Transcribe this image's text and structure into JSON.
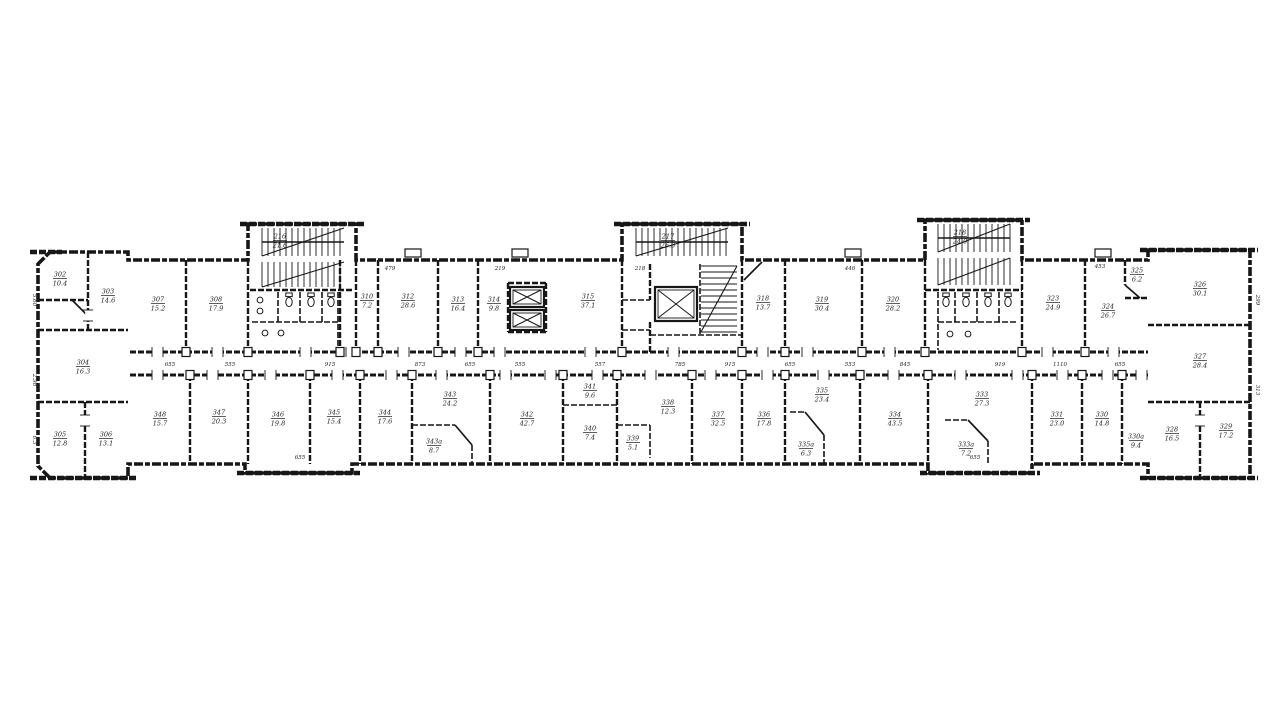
{
  "plan": {
    "ink": "#171717",
    "paper": "#ffffff",
    "outline": [
      38,
      264,
      50,
      252,
      128,
      252,
      128,
      260,
      248,
      260,
      248,
      224,
      356,
      224,
      356,
      260,
      622,
      260,
      622,
      224,
      742,
      224,
      742,
      260,
      925,
      260,
      925,
      220,
      1022,
      220,
      1022,
      260,
      1148,
      260,
      1148,
      250,
      1250,
      250,
      1250,
      478,
      1148,
      478,
      1148,
      464,
      1032,
      464,
      1032,
      473,
      928,
      473,
      928,
      464,
      352,
      464,
      352,
      473,
      245,
      473,
      245,
      464,
      128,
      464,
      128,
      478,
      50,
      478,
      38,
      466
    ],
    "caps": [
      [
        240,
        224,
        364,
        224
      ],
      [
        614,
        224,
        750,
        224
      ],
      [
        917,
        220,
        1030,
        220
      ],
      [
        30,
        252,
        62,
        252
      ],
      [
        1140,
        250,
        1258,
        250
      ],
      [
        237,
        473,
        360,
        473
      ],
      [
        920,
        473,
        1040,
        473
      ],
      [
        30,
        478,
        136,
        478
      ],
      [
        1140,
        478,
        1258,
        478
      ]
    ],
    "walls": [
      [
        130,
        352,
        1148,
        352,
        3
      ],
      [
        130,
        375,
        1148,
        375,
        3
      ],
      [
        38,
        330,
        128,
        330,
        2.4
      ],
      [
        38,
        402,
        128,
        402,
        2.4
      ],
      [
        38,
        300,
        88,
        300,
        2.4
      ],
      [
        88,
        252,
        88,
        330,
        2.4
      ],
      [
        85,
        402,
        85,
        478,
        2.4
      ],
      [
        1148,
        325,
        1250,
        325,
        2.4
      ],
      [
        1148,
        402,
        1250,
        402,
        2.4
      ],
      [
        1200,
        402,
        1200,
        478,
        2.4
      ],
      [
        1125,
        260,
        1125,
        285,
        2.4
      ],
      [
        1125,
        298,
        1148,
        298,
        2.4
      ],
      [
        186,
        260,
        186,
        352,
        2.4
      ],
      [
        248,
        260,
        248,
        352,
        2.4
      ],
      [
        340,
        260,
        340,
        352,
        2.4
      ],
      [
        356,
        260,
        356,
        352,
        2.4
      ],
      [
        378,
        260,
        378,
        352,
        2.4
      ],
      [
        438,
        260,
        438,
        352,
        2.4
      ],
      [
        478,
        260,
        478,
        352,
        2.4
      ],
      [
        508,
        283,
        508,
        332,
        2.4
      ],
      [
        546,
        283,
        546,
        332,
        2.4
      ],
      [
        508,
        283,
        546,
        283,
        2.4
      ],
      [
        508,
        332,
        546,
        332,
        2.4
      ],
      [
        622,
        260,
        622,
        352,
        2.4
      ],
      [
        650,
        264,
        650,
        300,
        2.4
      ],
      [
        650,
        322,
        650,
        352,
        2.4
      ],
      [
        742,
        260,
        742,
        352,
        2.4
      ],
      [
        785,
        260,
        785,
        352,
        2.4
      ],
      [
        862,
        260,
        862,
        352,
        2.4
      ],
      [
        925,
        260,
        925,
        352,
        2.4
      ],
      [
        1022,
        260,
        1022,
        352,
        2.4
      ],
      [
        1085,
        260,
        1085,
        352,
        2.4
      ],
      [
        250,
        290,
        354,
        290,
        2.4
      ],
      [
        252,
        322,
        338,
        322,
        1.6
      ],
      [
        278,
        292,
        278,
        322,
        1.6
      ],
      [
        300,
        292,
        300,
        322,
        1.6
      ],
      [
        322,
        292,
        322,
        322,
        1.6
      ],
      [
        338,
        292,
        338,
        352,
        1.6
      ],
      [
        622,
        300,
        650,
        300,
        1.6
      ],
      [
        622,
        330,
        650,
        330,
        1.6
      ],
      [
        700,
        264,
        700,
        335,
        1.6
      ],
      [
        650,
        335,
        742,
        335,
        1.6
      ],
      [
        925,
        290,
        1022,
        290,
        2.4
      ],
      [
        938,
        292,
        938,
        350,
        1.6
      ],
      [
        955,
        292,
        955,
        322,
        1.6
      ],
      [
        977,
        292,
        977,
        322,
        1.6
      ],
      [
        999,
        292,
        999,
        322,
        1.6
      ],
      [
        938,
        322,
        1018,
        322,
        1.6
      ],
      [
        190,
        375,
        190,
        464,
        2.4
      ],
      [
        248,
        375,
        248,
        464,
        2.4
      ],
      [
        310,
        375,
        310,
        464,
        2.4
      ],
      [
        360,
        375,
        360,
        464,
        2.4
      ],
      [
        412,
        375,
        412,
        464,
        2.4
      ],
      [
        490,
        375,
        490,
        464,
        2.4
      ],
      [
        563,
        375,
        563,
        464,
        2.4
      ],
      [
        617,
        375,
        617,
        464,
        2.4
      ],
      [
        692,
        375,
        692,
        464,
        2.4
      ],
      [
        742,
        375,
        742,
        464,
        2.4
      ],
      [
        785,
        375,
        785,
        464,
        2.4
      ],
      [
        860,
        375,
        860,
        464,
        2.4
      ],
      [
        928,
        375,
        928,
        464,
        2.4
      ],
      [
        1032,
        375,
        1032,
        464,
        2.4
      ],
      [
        1082,
        375,
        1082,
        464,
        2.4
      ],
      [
        1122,
        375,
        1122,
        464,
        2.4
      ],
      [
        412,
        425,
        455,
        425,
        1.6
      ],
      [
        472,
        445,
        472,
        464,
        1.6
      ],
      [
        563,
        405,
        617,
        405,
        1.6
      ],
      [
        617,
        425,
        650,
        425,
        1.6
      ],
      [
        650,
        425,
        650,
        458,
        1.6
      ],
      [
        790,
        412,
        805,
        412,
        1.6
      ],
      [
        824,
        435,
        824,
        464,
        1.6
      ],
      [
        945,
        420,
        968,
        420,
        1.6
      ],
      [
        988,
        441,
        988,
        464,
        1.6
      ]
    ],
    "diagonals": [
      [
        72,
        300,
        88,
        316
      ],
      [
        1125,
        285,
        1140,
        298
      ],
      [
        744,
        280,
        762,
        262
      ],
      [
        455,
        425,
        472,
        445
      ],
      [
        805,
        412,
        824,
        435
      ],
      [
        968,
        420,
        988,
        441
      ]
    ],
    "doors_top": [
      152,
      212,
      300,
      346,
      398,
      455,
      494,
      585,
      668,
      757,
      802,
      884,
      1042,
      1108
    ],
    "doors_bottom": [
      152,
      207,
      265,
      332,
      386,
      436,
      500,
      545,
      592,
      645,
      705,
      762,
      818,
      888,
      955,
      1012,
      1057,
      1102,
      1136
    ],
    "doors_vertical": [
      [
        88,
        310
      ],
      [
        85,
        415
      ],
      [
        1200,
        415
      ]
    ],
    "studs_top": [
      186,
      248,
      340,
      356,
      378,
      438,
      478,
      622,
      742,
      785,
      862,
      925,
      1022,
      1085
    ],
    "studs_bottom": [
      190,
      248,
      310,
      360,
      412,
      490,
      563,
      617,
      692,
      742,
      785,
      860,
      928,
      1032,
      1082,
      1122
    ],
    "tabs": [
      [
        405,
        249,
        16,
        8
      ],
      [
        512,
        249,
        16,
        8
      ],
      [
        845,
        249,
        16,
        8
      ],
      [
        1095,
        249,
        16,
        8
      ]
    ],
    "stairs": [
      {
        "type": "v",
        "x1": 262,
        "y1": 228,
        "x2": 344,
        "y2": 256,
        "step": 6,
        "mid": 1,
        "diag": 1
      },
      {
        "type": "v",
        "x1": 262,
        "y1": 262,
        "x2": 344,
        "y2": 287,
        "step": 6,
        "mid": 0,
        "diag": 1
      },
      {
        "type": "v",
        "x1": 636,
        "y1": 228,
        "x2": 728,
        "y2": 256,
        "step": 6,
        "mid": 1,
        "diag": 1
      },
      {
        "type": "h",
        "x1": 701,
        "y1": 266,
        "x2": 737,
        "y2": 332,
        "step": 6,
        "mid": 0,
        "diag": 1
      },
      {
        "type": "v",
        "x1": 938,
        "y1": 224,
        "x2": 1010,
        "y2": 252,
        "step": 6,
        "mid": 1,
        "diag": 1
      },
      {
        "type": "v",
        "x1": 938,
        "y1": 258,
        "x2": 1010,
        "y2": 285,
        "step": 6,
        "mid": 0,
        "diag": 1
      }
    ],
    "elevators": [
      [
        510,
        287,
        34,
        20
      ],
      [
        510,
        310,
        34,
        20
      ],
      [
        655,
        287,
        42,
        34
      ]
    ],
    "toilets": [
      [
        289,
        302
      ],
      [
        311,
        302
      ],
      [
        331,
        302
      ],
      [
        946,
        302
      ],
      [
        966,
        302
      ],
      [
        988,
        302
      ],
      [
        1008,
        302
      ]
    ],
    "sinks": [
      [
        260,
        300
      ],
      [
        260,
        311
      ],
      [
        265,
        333
      ],
      [
        281,
        333
      ],
      [
        950,
        334
      ],
      [
        968,
        334
      ]
    ],
    "labels": [
      {
        "x": 60,
        "y": 278,
        "n": "302",
        "a": "10.4"
      },
      {
        "x": 108,
        "y": 295,
        "n": "303",
        "a": "14.6"
      },
      {
        "x": 83,
        "y": 366,
        "n": "304",
        "a": "16.3"
      },
      {
        "x": 60,
        "y": 438,
        "n": "305",
        "a": "12.8"
      },
      {
        "x": 106,
        "y": 438,
        "n": "306",
        "a": "13.1"
      },
      {
        "x": 158,
        "y": 303,
        "n": "307",
        "a": "15.2"
      },
      {
        "x": 216,
        "y": 303,
        "n": "308",
        "a": "17.9"
      },
      {
        "x": 280,
        "y": 240,
        "n": "216",
        "a": "21.6"
      },
      {
        "x": 668,
        "y": 240,
        "n": "217",
        "a": "26.3"
      },
      {
        "x": 960,
        "y": 236,
        "n": "218",
        "a": "24.0"
      },
      {
        "x": 367,
        "y": 300,
        "n": "310",
        "a": "7.2"
      },
      {
        "x": 408,
        "y": 300,
        "n": "312",
        "a": "28.6"
      },
      {
        "x": 458,
        "y": 303,
        "n": "313",
        "a": "16.4"
      },
      {
        "x": 494,
        "y": 303,
        "n": "314",
        "a": "9.8"
      },
      {
        "x": 588,
        "y": 300,
        "n": "315",
        "a": "37.1"
      },
      {
        "x": 763,
        "y": 302,
        "n": "318",
        "a": "13.7"
      },
      {
        "x": 822,
        "y": 303,
        "n": "319",
        "a": "30.4"
      },
      {
        "x": 893,
        "y": 303,
        "n": "320",
        "a": "28.2"
      },
      {
        "x": 1053,
        "y": 302,
        "n": "323",
        "a": "24.9"
      },
      {
        "x": 1108,
        "y": 310,
        "n": "324",
        "a": "26.7"
      },
      {
        "x": 1137,
        "y": 274,
        "n": "325",
        "a": "6.2"
      },
      {
        "x": 1200,
        "y": 288,
        "n": "326",
        "a": "30.1"
      },
      {
        "x": 1200,
        "y": 360,
        "n": "327",
        "a": "28.4"
      },
      {
        "x": 1172,
        "y": 433,
        "n": "328",
        "a": "16.5"
      },
      {
        "x": 1226,
        "y": 430,
        "n": "329",
        "a": "17.2"
      },
      {
        "x": 160,
        "y": 418,
        "n": "348",
        "a": "15.7"
      },
      {
        "x": 219,
        "y": 416,
        "n": "347",
        "a": "20.3"
      },
      {
        "x": 278,
        "y": 418,
        "n": "346",
        "a": "19.8"
      },
      {
        "x": 334,
        "y": 416,
        "n": "345",
        "a": "15.4"
      },
      {
        "x": 385,
        "y": 416,
        "n": "344",
        "a": "17.6"
      },
      {
        "x": 450,
        "y": 398,
        "n": "343",
        "a": "24.2"
      },
      {
        "x": 434,
        "y": 445,
        "n": "343a",
        "a": "8.7"
      },
      {
        "x": 527,
        "y": 418,
        "n": "342",
        "a": "42.7"
      },
      {
        "x": 590,
        "y": 390,
        "n": "341",
        "a": "9.6"
      },
      {
        "x": 590,
        "y": 432,
        "n": "340",
        "a": "7.4"
      },
      {
        "x": 633,
        "y": 442,
        "n": "339",
        "a": "5.1"
      },
      {
        "x": 668,
        "y": 406,
        "n": "338",
        "a": "12.3"
      },
      {
        "x": 718,
        "y": 418,
        "n": "337",
        "a": "32.5"
      },
      {
        "x": 764,
        "y": 418,
        "n": "336",
        "a": "17.8"
      },
      {
        "x": 822,
        "y": 394,
        "n": "335",
        "a": "23.4"
      },
      {
        "x": 806,
        "y": 448,
        "n": "335a",
        "a": "6.3"
      },
      {
        "x": 895,
        "y": 418,
        "n": "334",
        "a": "43.5"
      },
      {
        "x": 982,
        "y": 398,
        "n": "333",
        "a": "27.3"
      },
      {
        "x": 966,
        "y": 448,
        "n": "333a",
        "a": "7.2"
      },
      {
        "x": 1057,
        "y": 418,
        "n": "331",
        "a": "23.0"
      },
      {
        "x": 1102,
        "y": 418,
        "n": "330",
        "a": "14.8"
      },
      {
        "x": 1136,
        "y": 440,
        "n": "330a",
        "a": "9.4"
      }
    ],
    "dims": [
      {
        "x": 170,
        "y": 366,
        "t": "655",
        "r": 0
      },
      {
        "x": 230,
        "y": 366,
        "t": "555",
        "r": 0
      },
      {
        "x": 330,
        "y": 366,
        "t": "915",
        "r": 0
      },
      {
        "x": 420,
        "y": 366,
        "t": "873",
        "r": 0
      },
      {
        "x": 470,
        "y": 366,
        "t": "655",
        "r": 0
      },
      {
        "x": 520,
        "y": 366,
        "t": "555",
        "r": 0
      },
      {
        "x": 600,
        "y": 366,
        "t": "557",
        "r": 0
      },
      {
        "x": 680,
        "y": 366,
        "t": "785",
        "r": 0
      },
      {
        "x": 730,
        "y": 366,
        "t": "915",
        "r": 0
      },
      {
        "x": 790,
        "y": 366,
        "t": "655",
        "r": 0
      },
      {
        "x": 850,
        "y": 366,
        "t": "553",
        "r": 0
      },
      {
        "x": 905,
        "y": 366,
        "t": "845",
        "r": 0
      },
      {
        "x": 1000,
        "y": 366,
        "t": "919",
        "r": 0
      },
      {
        "x": 1060,
        "y": 366,
        "t": "1110",
        "r": 0
      },
      {
        "x": 1120,
        "y": 366,
        "t": "655",
        "r": 0
      },
      {
        "x": 390,
        "y": 270,
        "t": "479",
        "r": 0
      },
      {
        "x": 500,
        "y": 270,
        "t": "219",
        "r": 0
      },
      {
        "x": 640,
        "y": 270,
        "t": "218",
        "r": 0
      },
      {
        "x": 850,
        "y": 270,
        "t": "446",
        "r": 0
      },
      {
        "x": 1100,
        "y": 268,
        "t": "453",
        "r": 0
      },
      {
        "x": 33,
        "y": 300,
        "t": "5.60",
        "r": 90
      },
      {
        "x": 33,
        "y": 380,
        "t": "2.98",
        "r": 90
      },
      {
        "x": 33,
        "y": 440,
        "t": "6.3",
        "r": 90
      },
      {
        "x": 1256,
        "y": 300,
        "t": "299",
        "r": 90
      },
      {
        "x": 1256,
        "y": 390,
        "t": "313",
        "r": 90
      },
      {
        "x": 300,
        "y": 459,
        "t": "655",
        "r": 0
      },
      {
        "x": 975,
        "y": 459,
        "t": "655",
        "r": 0
      }
    ]
  }
}
